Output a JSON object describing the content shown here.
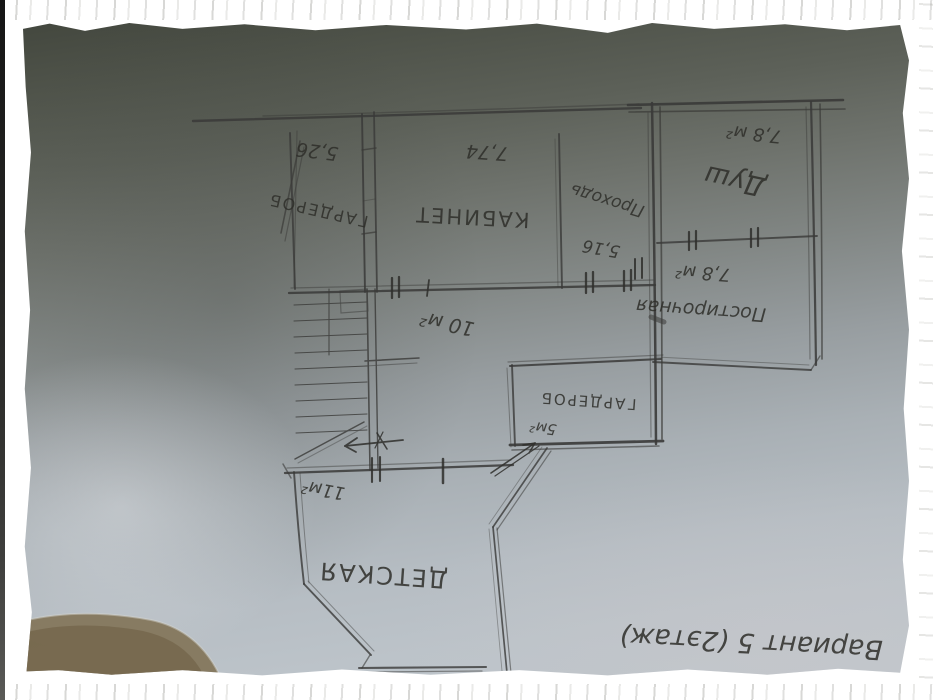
{
  "plan": {
    "caption": "Вариант 5 (2этаж)",
    "rooms": [
      {
        "id": "wardrobe-top",
        "name": "ГАРДЕРОБ",
        "area": "5,26"
      },
      {
        "id": "cabinet",
        "name": "КАБИНЕТ",
        "area": "7,74"
      },
      {
        "id": "passage",
        "name": "Проходь",
        "area": "5,16"
      },
      {
        "id": "shower",
        "name": "Душ",
        "area": "7,8 м²"
      },
      {
        "id": "laundry",
        "name": "Постирочная",
        "area": "7,8 м²"
      },
      {
        "id": "hall",
        "name": "",
        "area": "10 м²"
      },
      {
        "id": "wardrobe-bottom",
        "name": "ГАРДЕРОБ",
        "area": "5м²"
      },
      {
        "id": "kids-room",
        "name": "ДЕТСКАЯ",
        "area": "11м²"
      }
    ],
    "colors": {
      "pencil": "#3a3a38",
      "paper_shadow": "#4b4f46",
      "paper_light": "#bfc6cc",
      "frame": "#ffffff",
      "table": "#7e6e50"
    }
  }
}
